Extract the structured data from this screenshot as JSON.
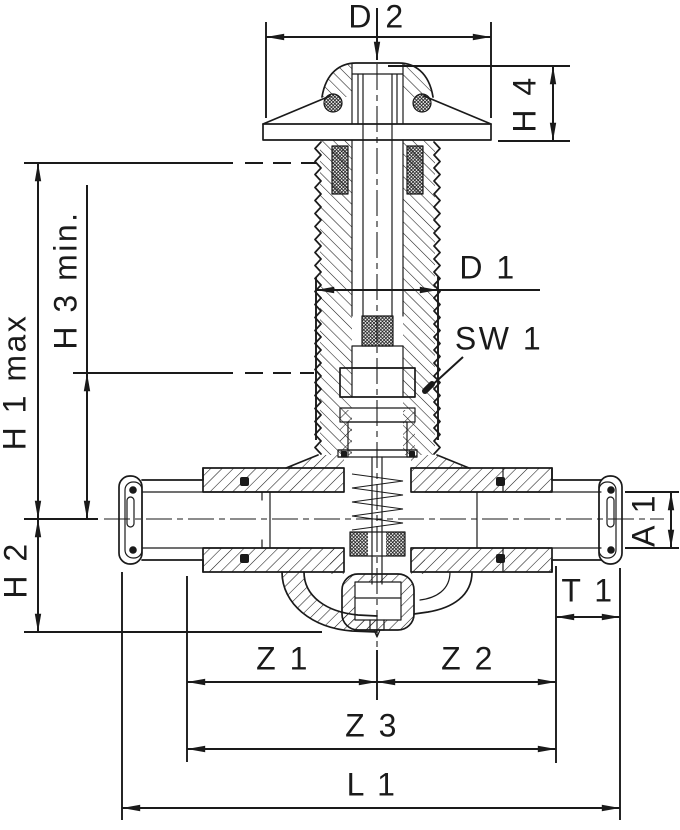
{
  "drawing": {
    "background": "#ffffff",
    "line_color": "#1a1a1a",
    "type": "valve cross-section technical drawing",
    "dimensions": {
      "d2": {
        "label": "D 2"
      },
      "h4": {
        "label": "H 4"
      },
      "h1_max": {
        "label": "H 1 max"
      },
      "h3_min": {
        "label": "H 3 min."
      },
      "h2": {
        "label": "H 2"
      },
      "d1": {
        "label": "D 1"
      },
      "sw1": {
        "label": "SW 1"
      },
      "a1": {
        "label": "A 1"
      },
      "t1": {
        "label": "T 1"
      },
      "z1": {
        "label": "Z 1"
      },
      "z2": {
        "label": "Z 2"
      },
      "z3": {
        "label": "Z 3"
      },
      "l1": {
        "label": "L 1"
      }
    }
  }
}
